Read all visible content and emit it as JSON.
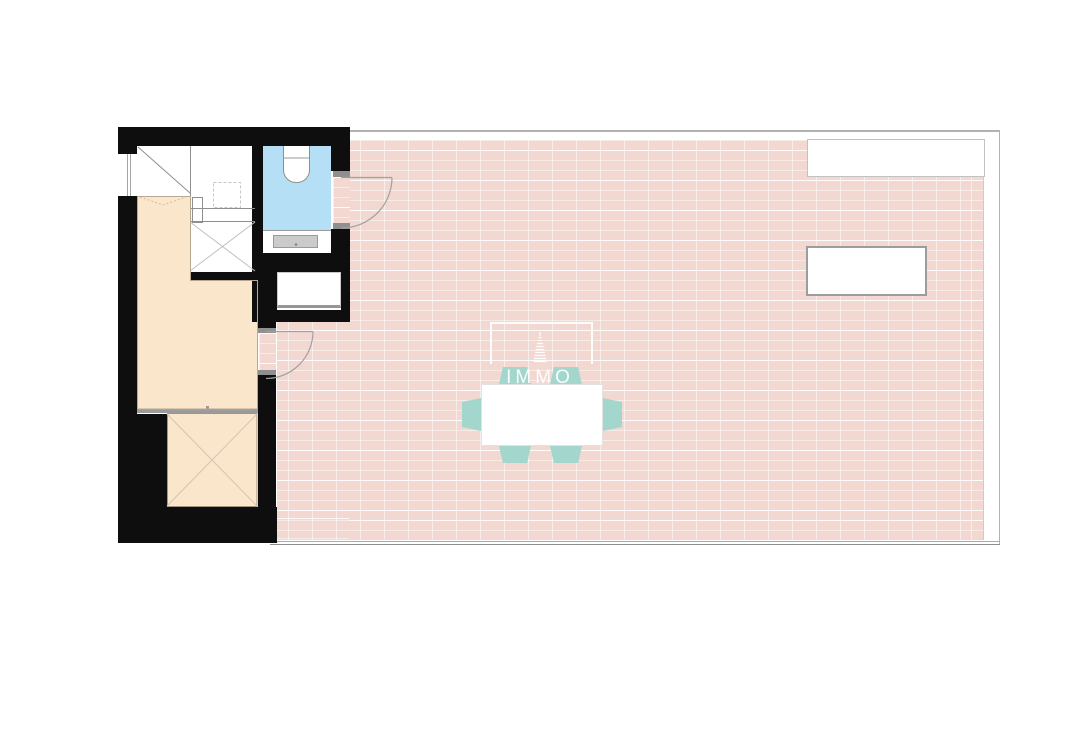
{
  "watermark": {
    "brand": "IMMO",
    "logo_icon": "tower-spire-icon"
  },
  "palette": {
    "background": "#ffffff",
    "wall_black": "#0e0e0e",
    "terrace_tile_pink": "#f2d8d0",
    "tile_grout": "#ffffff",
    "room_beige": "#fae6ca",
    "bathroom_blue": "#b5dff4",
    "chair_teal": "#a3d7cd",
    "fixture_gray": "#cbcbcb",
    "line_gray": "#9a9a9a"
  },
  "plan_elements": [
    "staircase",
    "toilet",
    "vanity-unit",
    "wall-niche",
    "window",
    "door-swing",
    "void-shaft",
    "dining-table",
    "chair",
    "skylight",
    "roof-opening",
    "terrace-tiling"
  ]
}
